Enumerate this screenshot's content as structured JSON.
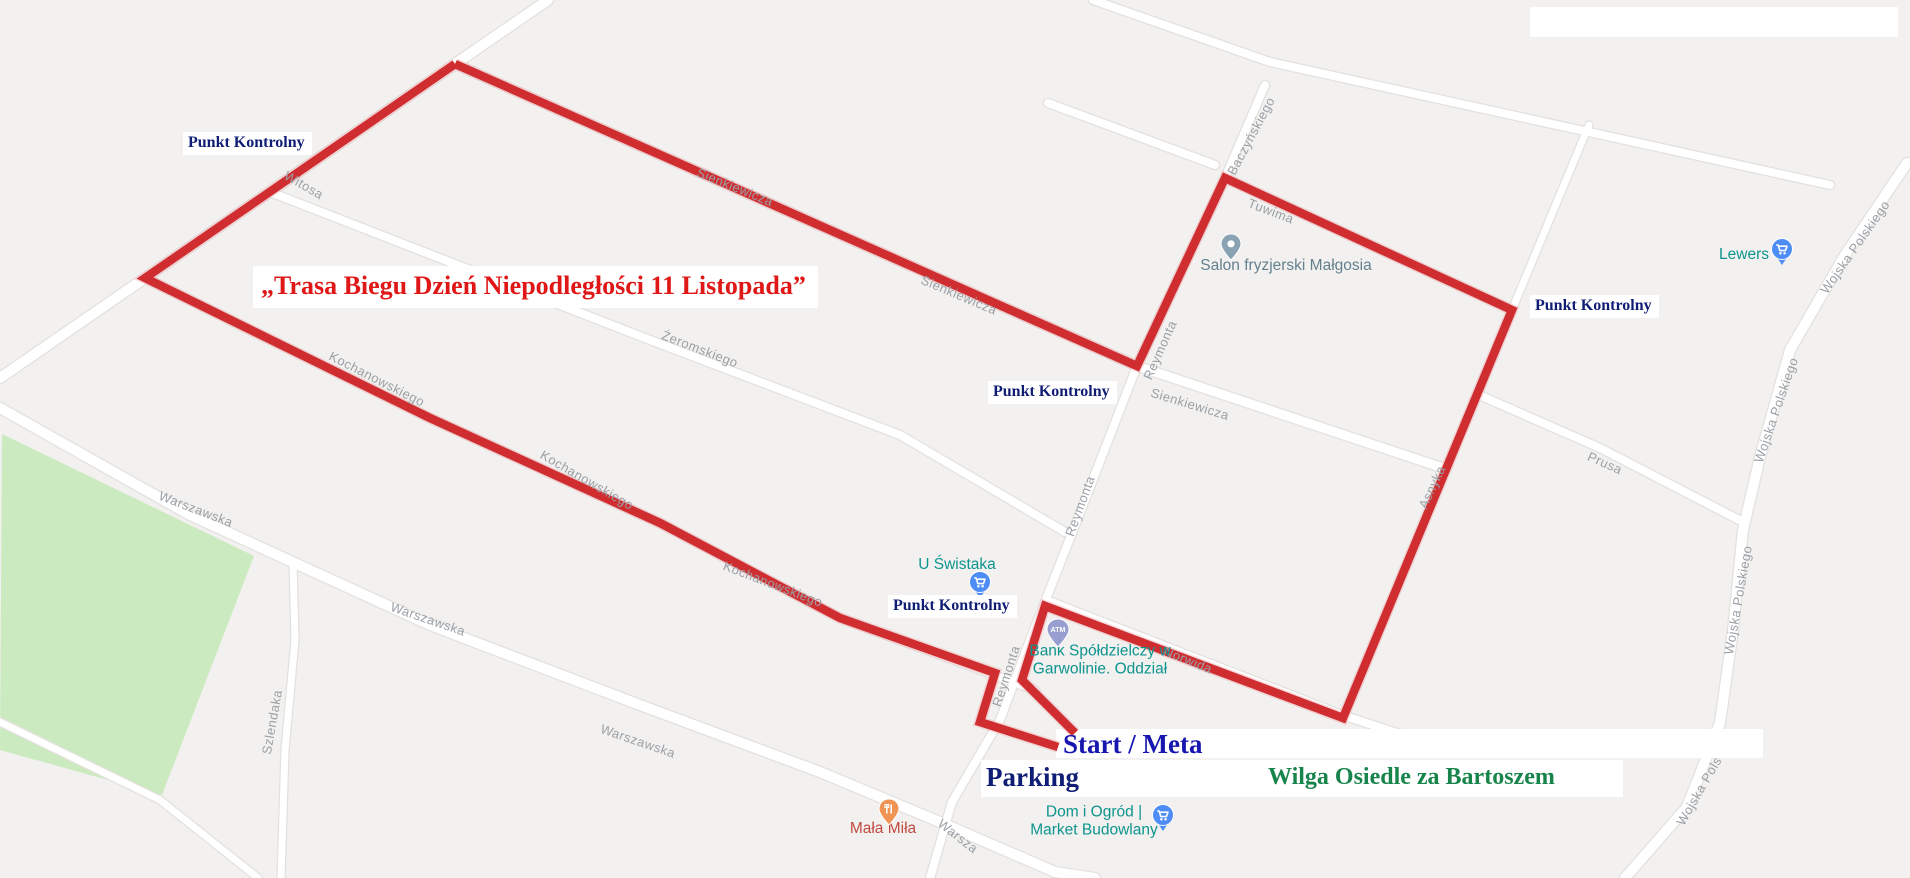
{
  "map": {
    "canvas": {
      "width": 1910,
      "height": 878,
      "background": "#f2f1ef"
    },
    "colors": {
      "street_fill": "#ffffff",
      "street_casing": "#e3e1de",
      "park_green": "#cbeabf",
      "route_red": "#cf2d30",
      "route_halo": "#f0b9bd",
      "street_label_gray": "#9aa0a6",
      "checkpoint_navy": "#101d75",
      "title_red": "#e01717",
      "start_meta_blue": "#1717b0",
      "wilga_green": "#17854b",
      "poi_teal": "#0e948f",
      "poi_gray_blue": "#64808f",
      "poi_red": "#c0493f",
      "pin_blue": "#4e8df5",
      "pin_violet": "#989fd0",
      "pin_orange": "#ef9455",
      "pin_gray_blue": "#8aa3b3"
    },
    "park": {
      "points": "2,434 254,556 162,795 0,750"
    },
    "streets": [
      {
        "name": "witosa",
        "w": 10,
        "pts": "548,0 455,64 145,278 0,378"
      },
      {
        "name": "sienkiewicza",
        "w": 9,
        "pts": "455,64 1137,366 1446,469"
      },
      {
        "name": "zeromskiego",
        "w": 8,
        "pts": "270,192 650,340 900,435 1065,532"
      },
      {
        "name": "kochanowskiego",
        "w": 8,
        "pts": "145,278 430,418 660,523 840,618 1035,690"
      },
      {
        "name": "reymonta",
        "w": 8,
        "pts": "1225,178 1137,366 1085,500 1030,640 1000,720 952,802 930,878"
      },
      {
        "name": "warszawska",
        "w": 10,
        "pts": "0,408 190,515 430,625 640,705 820,772 935,820 1055,872 1095,878"
      },
      {
        "name": "szlendaka",
        "w": 7,
        "pts": "293,562 295,640 285,750 281,878"
      },
      {
        "name": "wojska-polskiego",
        "w": 10,
        "pts": "1907,163 1845,255 1790,350 1760,457 1743,530 1733,630 1720,723 1687,807 1625,878"
      },
      {
        "name": "prusa",
        "w": 8,
        "pts": "1479,395 1600,448 1743,522"
      },
      {
        "name": "tuwima",
        "w": 8,
        "pts": "1225,178 1512,310"
      },
      {
        "name": "baczynskiego",
        "w": 8,
        "pts": "1265,85 1225,178"
      },
      {
        "name": "asnyka",
        "w": 7,
        "pts": "1589,125 1512,310 1343,718"
      },
      {
        "name": "norwida",
        "w": 8,
        "pts": "1046,600 1345,716 1455,752"
      },
      {
        "name": "northeast-road",
        "w": 8,
        "pts": "1093,0 1270,62 1830,185"
      },
      {
        "name": "stub-road",
        "w": 8,
        "pts": "1048,103 1215,165"
      },
      {
        "name": "southwest-road",
        "w": 7,
        "pts": "0,722 160,800 258,878"
      }
    ],
    "white_boxes": [
      {
        "name": "top-right-blank-box",
        "x": 1530,
        "y": 7,
        "w": 368,
        "h": 30
      },
      {
        "name": "start-meta-strip",
        "x": 1056,
        "y": 729,
        "w": 707,
        "h": 29
      },
      {
        "name": "parking-wilga-strip",
        "x": 981,
        "y": 760,
        "w": 642,
        "h": 37
      }
    ],
    "route": {
      "width": 8.5,
      "polylines": [
        "455,64 1137,366 1225,178 1512,310 1343,718 1045,606 1022,680 1075,733",
        "455,64 145,278 430,418 660,523 840,618 995,673 980,722 1058,747"
      ]
    },
    "street_labels": [
      {
        "t": "Witosa",
        "x": 304,
        "y": 185,
        "r": 30
      },
      {
        "t": "Sienkiewicza",
        "x": 735,
        "y": 187,
        "r": 22
      },
      {
        "t": "Sienkiewicza",
        "x": 959,
        "y": 295,
        "r": 23
      },
      {
        "t": "Sienkiewicza",
        "x": 1190,
        "y": 404,
        "r": 17
      },
      {
        "t": "Żeromskiego",
        "x": 700,
        "y": 349,
        "r": 21
      },
      {
        "t": "Kochanowskiego",
        "x": 377,
        "y": 379,
        "r": 27
      },
      {
        "t": "Kochanowskiego",
        "x": 587,
        "y": 480,
        "r": 30
      },
      {
        "t": "Kochanowskiego",
        "x": 773,
        "y": 584,
        "r": 21
      },
      {
        "t": "Reymonta",
        "x": 1160,
        "y": 350,
        "r": -66
      },
      {
        "t": "Reymonta",
        "x": 1080,
        "y": 506,
        "r": -70
      },
      {
        "t": "Reymonta",
        "x": 1006,
        "y": 676,
        "r": -72
      },
      {
        "t": "Tuwima",
        "x": 1271,
        "y": 211,
        "r": 21
      },
      {
        "t": "Baczyńskiego",
        "x": 1251,
        "y": 136,
        "r": -62
      },
      {
        "t": "Asnyka",
        "x": 1432,
        "y": 487,
        "r": -65
      },
      {
        "t": "Norwida",
        "x": 1188,
        "y": 660,
        "r": 22
      },
      {
        "t": "Prusa",
        "x": 1605,
        "y": 463,
        "r": 24
      },
      {
        "t": "Wojska Polskiego",
        "x": 1855,
        "y": 247,
        "r": -55
      },
      {
        "t": "Wojska Polskiego",
        "x": 1776,
        "y": 410,
        "r": -71
      },
      {
        "t": "Wojska Polskiego",
        "x": 1738,
        "y": 600,
        "r": -80
      },
      {
        "t": "Wojska Pols",
        "x": 1699,
        "y": 791,
        "r": -60
      },
      {
        "t": "Warszawska",
        "x": 196,
        "y": 509,
        "r": 21
      },
      {
        "t": "Warszawska",
        "x": 428,
        "y": 619,
        "r": 19
      },
      {
        "t": "Warszawska",
        "x": 638,
        "y": 741,
        "r": 19
      },
      {
        "t": "Warsza",
        "x": 958,
        "y": 836,
        "r": 38
      },
      {
        "t": "Szlendaka",
        "x": 272,
        "y": 722,
        "r": -80
      }
    ],
    "pois": [
      {
        "id": "u-swistaka",
        "lines": [
          "U Świstaka"
        ],
        "x": 957,
        "y": 565,
        "color": "#0e948f",
        "pin": {
          "kind": "cart",
          "x": 980,
          "y": 585
        }
      },
      {
        "id": "salon-fryzjerski",
        "lines": [
          "Salon fryzjerski Małgosia"
        ],
        "x": 1286,
        "y": 266,
        "color": "#64808f",
        "pin": {
          "kind": "place",
          "x": 1232,
          "y": 248
        }
      },
      {
        "id": "bank-spoldzielczy",
        "lines": [
          "Bank Spółdzielczy w",
          "Garwolinie. Oddział"
        ],
        "x": 1100,
        "y": 661,
        "color": "#0e948f",
        "pin": {
          "kind": "atm",
          "x": 1058,
          "y": 633
        }
      },
      {
        "id": "dom-i-ogrod",
        "lines": [
          "Dom i Ogród |",
          "Market Budowlany"
        ],
        "x": 1094,
        "y": 822,
        "color": "#0e948f",
        "pin": {
          "kind": "cart",
          "x": 1163,
          "y": 818
        }
      },
      {
        "id": "mala-mila",
        "lines": [
          "Mała Miła"
        ],
        "x": 883,
        "y": 829,
        "color": "#c0493f",
        "pin": {
          "kind": "food",
          "x": 890,
          "y": 813
        }
      },
      {
        "id": "lewers",
        "lines": [
          "Lewers"
        ],
        "x": 1744,
        "y": 255,
        "color": "#0e948f",
        "pin": {
          "kind": "cart",
          "x": 1782,
          "y": 252
        }
      }
    ],
    "annotations": {
      "title": {
        "text": "„Trasa Biegu Dzień Niepodległości 11 Listopada”"
      },
      "checkpoints": [
        {
          "label": "Punkt Kontrolny"
        },
        {
          "label": "Punkt Kontrolny"
        },
        {
          "label": "Punkt Kontrolny"
        },
        {
          "label": "Punkt Kontrolny"
        }
      ],
      "start_meta": {
        "text": "Start / Meta"
      },
      "parking": {
        "text": "Parking"
      },
      "wilga": {
        "text": "Wilga Osiedle za Bartoszem"
      }
    }
  }
}
